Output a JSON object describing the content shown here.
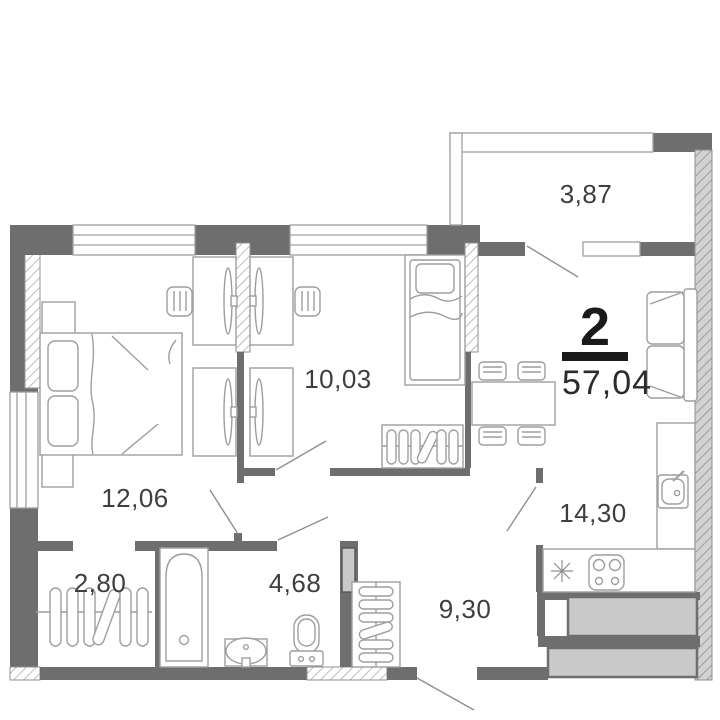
{
  "plan": {
    "type": "apartment-floor-plan",
    "rooms_count": "2",
    "total_area": "57,04",
    "rooms": [
      {
        "name": "balcony",
        "area": "3,87"
      },
      {
        "name": "children-room",
        "area": "10,03"
      },
      {
        "name": "bedroom",
        "area": "12,06"
      },
      {
        "name": "closet",
        "area": "2,80"
      },
      {
        "name": "bathroom",
        "area": "4,68"
      },
      {
        "name": "hallway",
        "area": "9,30"
      },
      {
        "name": "kitchen-living-room",
        "area": "14,30"
      }
    ],
    "colors": {
      "wall": "#6e6e6e",
      "furniture_stroke": "#9e9e9e",
      "shaft_fill": "#c9c9c9",
      "label_text": "#3e3e3e",
      "accent_black": "#1a1a1a"
    }
  }
}
